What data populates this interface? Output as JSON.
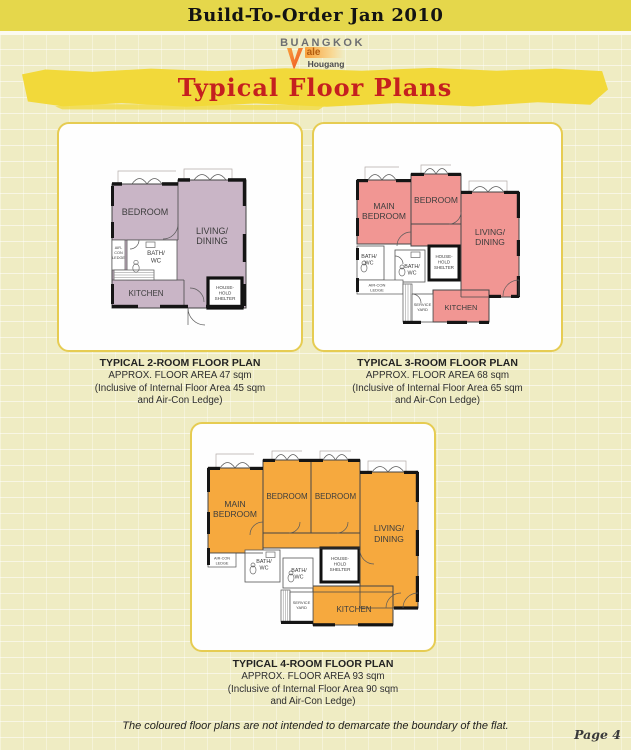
{
  "page": {
    "header_title": "Build-To-Order Jan 2010",
    "section_title": "Typical Floor Plans",
    "footnote": "The coloured floor plans are not intended to demarcate the boundary of the flat.",
    "page_number": "Page 4"
  },
  "logo": {
    "name": "BUANGKOK",
    "vale": "ale",
    "town": "Hougang"
  },
  "colors": {
    "header_band": "#e5d74b",
    "brush_yellow": "#f2d93a",
    "title_red": "#c5201f",
    "plan_2room_fill": "#c9b5c6",
    "plan_3room_fill": "#f19693",
    "plan_4room_fill": "#f6a93e",
    "card_border": "#e6cc52",
    "background_brick": "#efecc3"
  },
  "plans": [
    {
      "name": "2-room",
      "caption": [
        "TYPICAL 2-ROOM FLOOR PLAN",
        "APPROX. FLOOR AREA 47 sqm",
        "(Inclusive of Internal Floor Area 45 sqm",
        "and Air-Con Ledge)"
      ],
      "labels": {
        "bedroom": "BEDROOM",
        "living1": "LIVING/",
        "living2": "DINING",
        "aircon1": "AIR-",
        "aircon2": "CON",
        "aircon3": "LEDGE",
        "bath1": "BATH/",
        "bath2": "WC",
        "kitchen": "KITCHEN",
        "shelter1": "HOUSE-",
        "shelter2": "HOLD",
        "shelter3": "SHELTER"
      }
    },
    {
      "name": "3-room",
      "caption": [
        "TYPICAL 3-ROOM FLOOR PLAN",
        "APPROX. FLOOR AREA 68 sqm",
        "(Inclusive of Internal Floor Area 65 sqm",
        "and Air-Con Ledge)"
      ],
      "labels": {
        "main1": "MAIN",
        "main2": "BEDROOM",
        "bedroom": "BEDROOM",
        "living1": "LIVING/",
        "living2": "DINING",
        "bathA1": "BATH/",
        "bathA2": "WC",
        "bathB1": "BATH/",
        "bathB2": "WC",
        "shelter1": "HOUSE-",
        "shelter2": "HOLD",
        "shelter3": "SHELTER",
        "aircon1": "AIR-CON",
        "aircon2": "LEDGE",
        "service1": "SERVICE",
        "service2": "YARD",
        "kitchen": "KITCHEN"
      }
    },
    {
      "name": "4-room",
      "caption": [
        "TYPICAL 4-ROOM FLOOR PLAN",
        "APPROX. FLOOR AREA 93 sqm",
        "(Inclusive of Internal Floor Area 90 sqm",
        "and Air-Con Ledge)"
      ],
      "labels": {
        "main1": "MAIN",
        "main2": "BEDROOM",
        "bedroom1": "BEDROOM",
        "bedroom2": "BEDROOM",
        "living1": "LIVING/",
        "living2": "DINING",
        "aircon1": "AIR-CON",
        "aircon2": "LEDGE",
        "bathA1": "BATH/",
        "bathA2": "WC",
        "bathB1": "BATH/",
        "bathB2": "WC",
        "shelter1": "HOUSE-",
        "shelter2": "HOLD",
        "shelter3": "SHELTER",
        "service1": "SERVICE",
        "service2": "YARD",
        "kitchen": "KITCHEN"
      }
    }
  ]
}
